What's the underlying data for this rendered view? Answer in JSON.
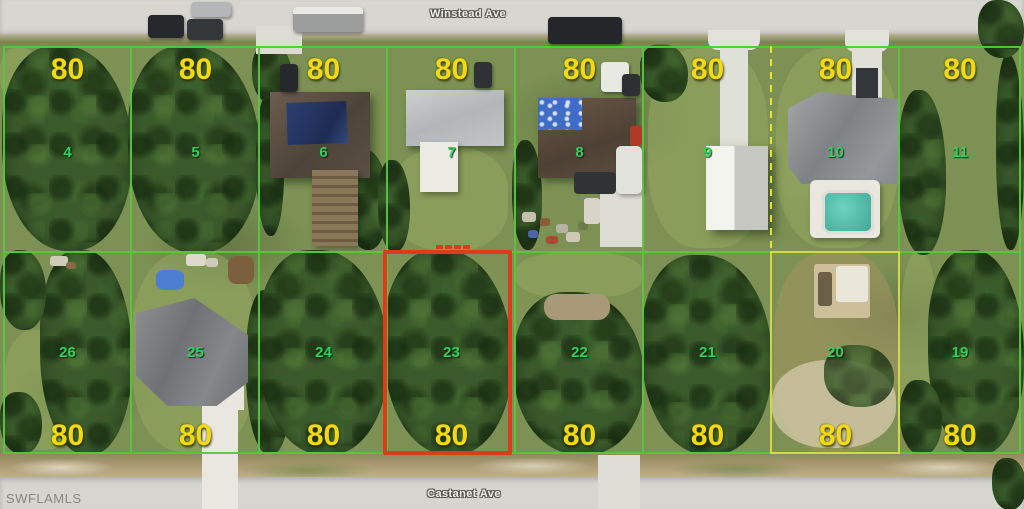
{
  "map": {
    "type": "aerial-parcel-map",
    "streets": {
      "top": "Winstead Ave",
      "bottom": "Castanet Ave"
    },
    "watermark": "SWFLAMLS",
    "dimension_label": "80",
    "highlight": {
      "lot": "23",
      "color": "#df3a1d"
    },
    "colors": {
      "boundary_green": "#56c83c",
      "boundary_yellow": "#d8dc42",
      "dimension_text": "#f2da12",
      "lot_number_text": "#2fd35b"
    },
    "rows": [
      {
        "side": "north",
        "street": "Winstead Ave",
        "lots": [
          {
            "number": "4",
            "dim": "80"
          },
          {
            "number": "5",
            "dim": "80"
          },
          {
            "number": "6",
            "dim": "80"
          },
          {
            "number": "7",
            "dim": "80"
          },
          {
            "number": "8",
            "dim": "80"
          },
          {
            "number": "9",
            "dim": "80"
          },
          {
            "number": "10",
            "dim": "80"
          },
          {
            "number": "11",
            "dim": "80"
          }
        ]
      },
      {
        "side": "south",
        "street": "Castanet Ave",
        "lots": [
          {
            "number": "26",
            "dim": "80"
          },
          {
            "number": "25",
            "dim": "80"
          },
          {
            "number": "24",
            "dim": "80"
          },
          {
            "number": "23",
            "dim": "80"
          },
          {
            "number": "22",
            "dim": "80"
          },
          {
            "number": "21",
            "dim": "80"
          },
          {
            "number": "20",
            "dim": "80"
          },
          {
            "number": "19",
            "dim": "80"
          }
        ]
      }
    ]
  }
}
